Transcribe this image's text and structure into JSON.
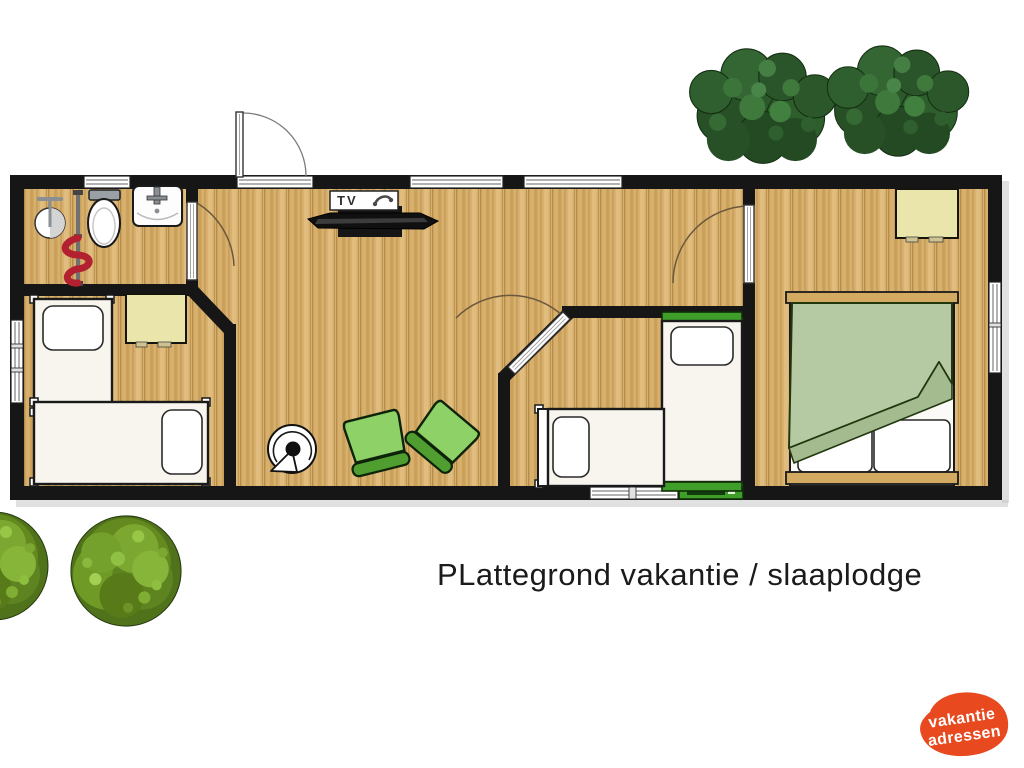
{
  "caption": "PLattegrond vakantie / slaaplodge",
  "tv": {
    "label": "TV"
  },
  "logo": {
    "line1": "vakantie",
    "line2": "adressen"
  },
  "colors": {
    "wall": "#161616",
    "floor_base": "#d7b06d",
    "floor_stripe": "#cba05a",
    "accent_green": "#3f9e2a",
    "chair_green": "#8ed167",
    "chair_dark": "#4f9e2f",
    "duvet_green": "#b5c9a3",
    "duvet_under": "#a4bb90",
    "bed_wood": "#d2aa62",
    "table_cream": "#eae5ab",
    "logo_orange": "#e8491f",
    "coil_red": "#b32030",
    "tree_green": "#2c592c",
    "bush_green": "#63891f"
  }
}
